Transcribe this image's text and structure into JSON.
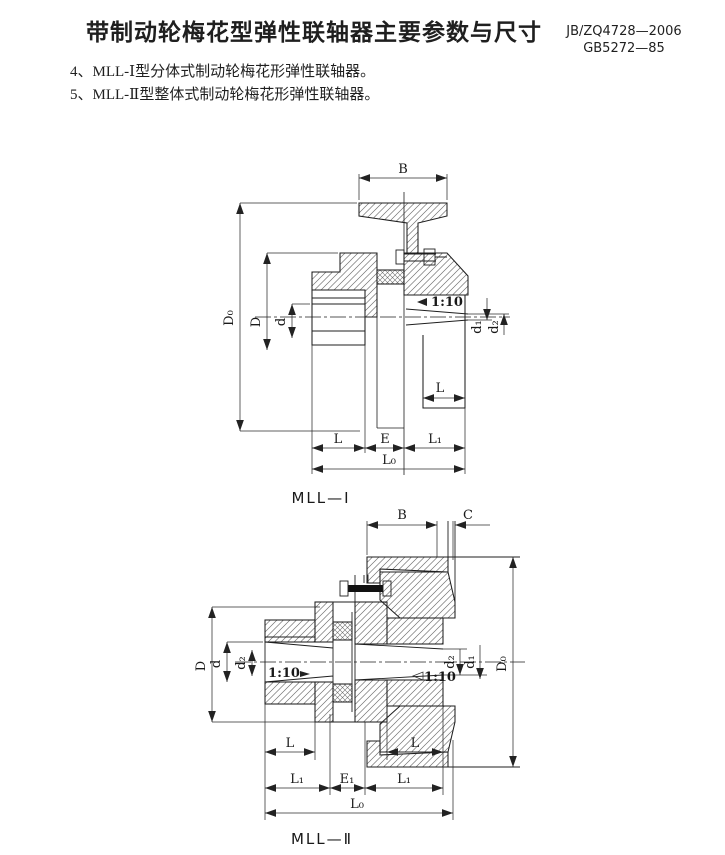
{
  "page": {
    "background": "#ffffff",
    "ink": "#1f1f1f"
  },
  "header": {
    "title": "带制动轮梅花型弹性联轴器主要参数与尺寸",
    "standard_line1": "JB/ZQ4728—2006",
    "standard_line2": "GB5272—85"
  },
  "notes": {
    "item4": "4、MLL-Ⅰ型分体式制动轮梅花形弹性联轴器。",
    "item5": "5、MLL-Ⅱ型整体式制动轮梅花形弹性联轴器。"
  },
  "figure1": {
    "caption": "MLL—Ⅰ",
    "labels": {
      "B": "B",
      "D0": "D₀",
      "D": "D",
      "d": "d",
      "taper": "1:10",
      "d1": "d₁",
      "d2": "d₂",
      "L_mid": "L",
      "L_bottom": "L",
      "E": "E",
      "L1": "L₁",
      "L0": "L₀"
    }
  },
  "figure2": {
    "caption": "MLL—Ⅱ",
    "labels": {
      "B": "B",
      "C": "C",
      "D": "D",
      "d": "d",
      "d2_left": "d₂",
      "taper_left": "1:10",
      "taper_right": "1:10",
      "d2_right": "d₂",
      "d1": "d₁",
      "D0": "D₀",
      "L_left": "L",
      "L_right": "L",
      "L1_left": "L₁",
      "E1": "E₁",
      "L1_right": "L₁",
      "L0": "L₀"
    }
  }
}
